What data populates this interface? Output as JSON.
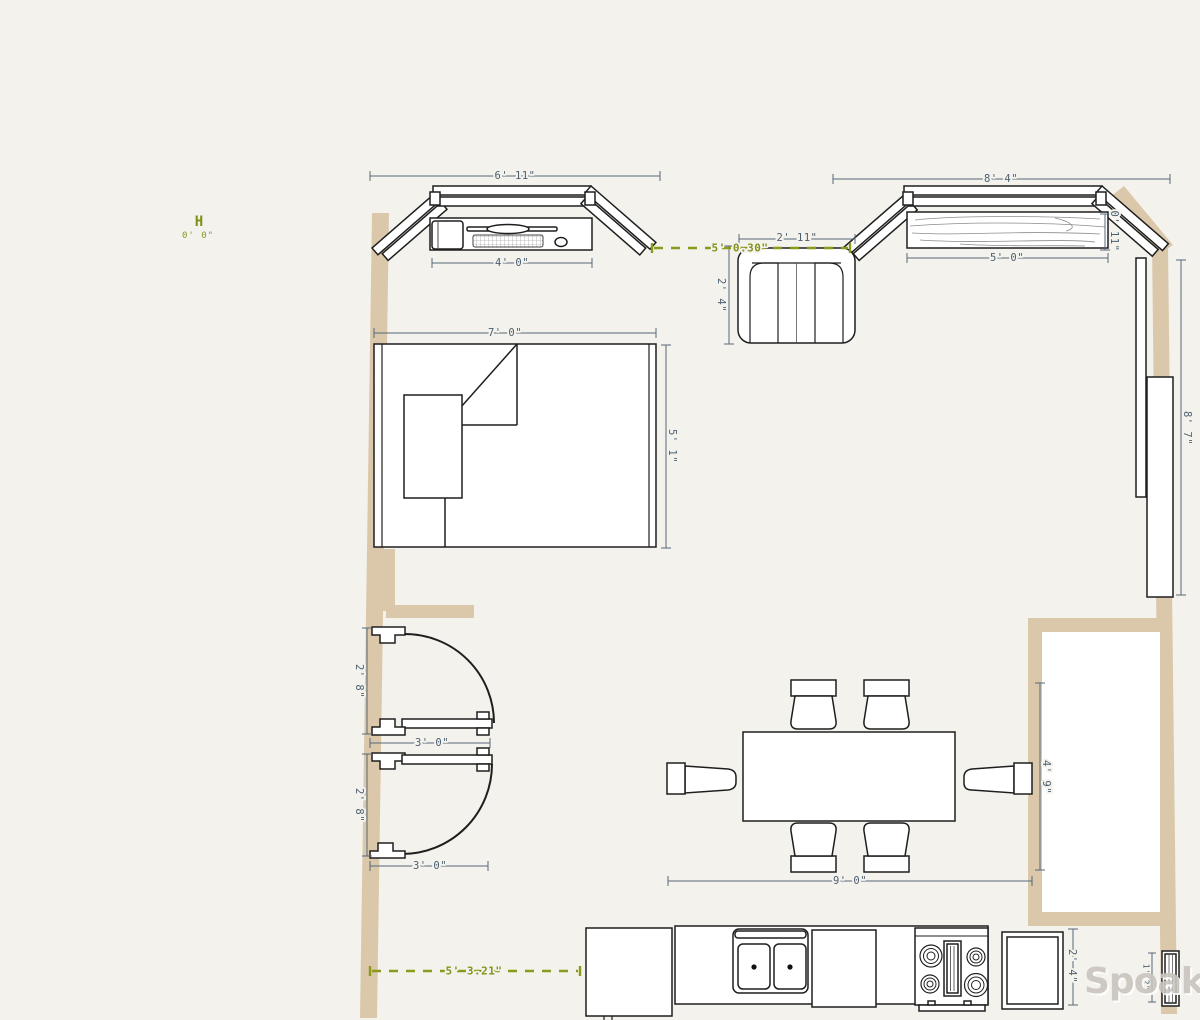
{
  "colors": {
    "background": "#f4f2ec",
    "wall": "#dbc8ab",
    "dimension": "#4d6071",
    "guide_green": "#84921a",
    "outline": "#1e1e1e",
    "watermark_gray": "#c9c5be"
  },
  "origin_marker": {
    "label": "H",
    "coordinates": "0' 0\""
  },
  "office_nook": {
    "bay_width": "6' 11\"",
    "desk_width": "4' 0\""
  },
  "media_nook": {
    "bay_width": "8' 4\"",
    "console_width": "5' 0\"",
    "console_depth": "0' 11\""
  },
  "armchair": {
    "width": "2' 11\"",
    "depth": "2' 4\""
  },
  "rug": {
    "width": "7' 0\"",
    "length": "5' 1\""
  },
  "wall_unit": {
    "height": "8' 7\""
  },
  "door_upper": {
    "opening": "3' 0\"",
    "leaf": "2' 8\""
  },
  "door_lower": {
    "opening": "3' 0\"",
    "leaf": "2' 8\""
  },
  "dining_set": {
    "width": "9' 0\"",
    "depth": "4' 9\""
  },
  "kitchen_run": {
    "depth": "2' 4\""
  },
  "radiator": {
    "height": "1' 2\""
  },
  "guides": {
    "top_gap": "5' 0.30\"",
    "bottom_gap": "5' 3.21\""
  },
  "watermark": {
    "text": "Spoak."
  }
}
